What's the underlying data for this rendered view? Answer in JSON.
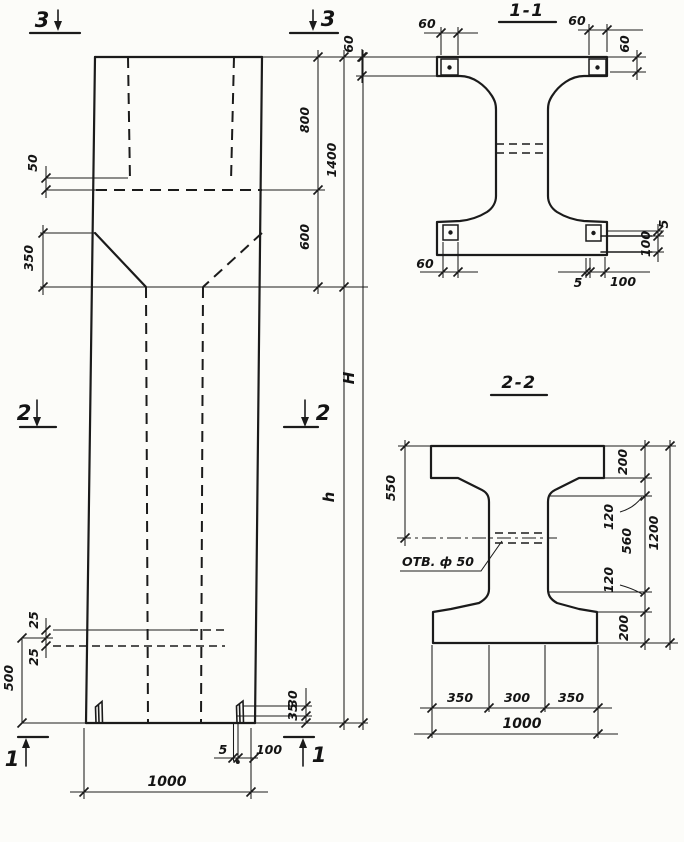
{
  "drawing": {
    "elevation": {
      "marks": {
        "top_left": "3",
        "top_right": "3",
        "mid_left": "2",
        "mid_right": "2",
        "bottom_left": "1",
        "bottom_right": "1"
      },
      "dims": {
        "ledge_offset": "50",
        "haunch_height": "350",
        "hole_above": "25",
        "hole_below": "25",
        "base_height": "500",
        "upper_segment": "800",
        "upper_total": "1400",
        "haunch_segment": "600",
        "overall_height": "H",
        "shaft_height": "h",
        "foot_upper": "30",
        "foot_lower": "35",
        "plate_thickness": "5",
        "plate_width": "100",
        "column_width": "1000"
      }
    },
    "section_1_1": {
      "title": "1-1",
      "dims": {
        "plate_top_left": "60",
        "edge_top_left": "60",
        "plate_top_right": "60",
        "edge_top_right": "60",
        "plate_bottom_left": "60",
        "gap_bottom": "5",
        "plate_bottom_width": "100",
        "gap_right": "5",
        "plate_right_height": "100"
      }
    },
    "section_2_2": {
      "title": "2-2",
      "hole_label": "ОТВ. ф 50",
      "dims": {
        "top_to_hole": "550",
        "top_flange": "200",
        "upper_haunch": "120",
        "web_height": "560",
        "lower_haunch": "120",
        "bottom_flange": "200",
        "overall_height": "1200",
        "bottom_left": "350",
        "bottom_middle": "300",
        "bottom_right": "350",
        "overall_width": "1000"
      }
    }
  }
}
